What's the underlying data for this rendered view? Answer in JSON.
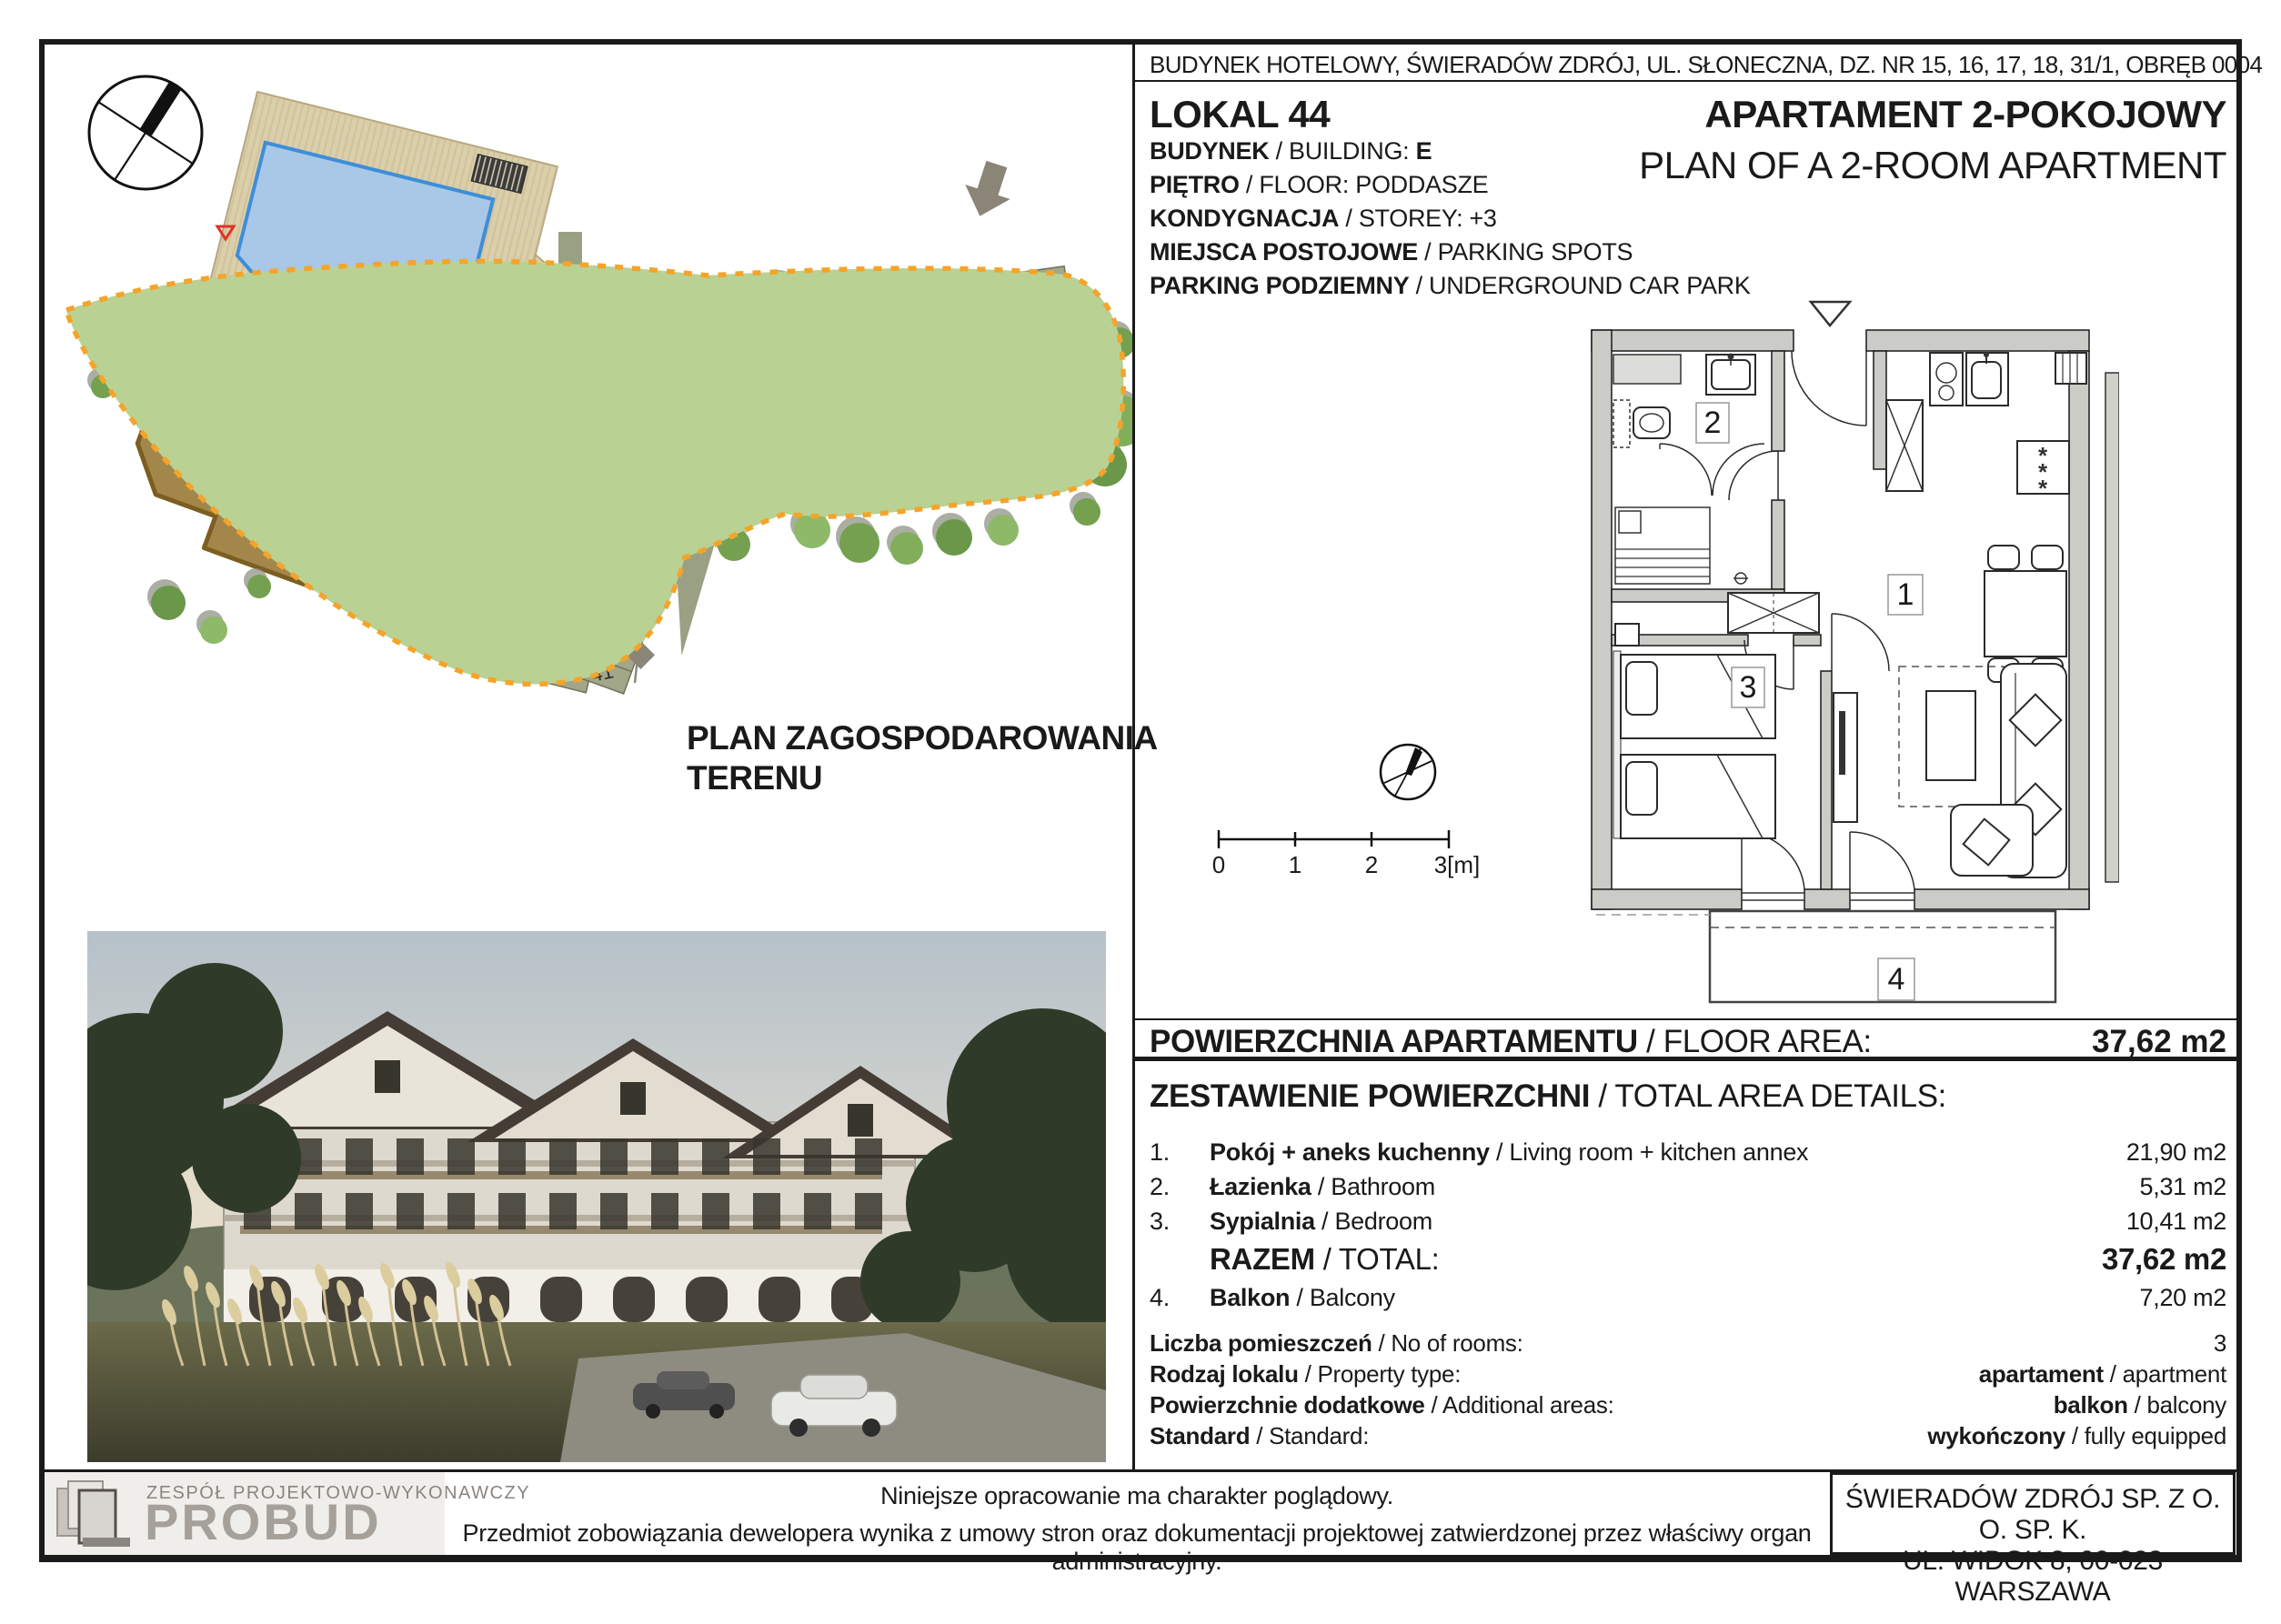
{
  "header": {
    "location_line": "BUDYNEK HOTELOWY, ŚWIERADÓW ZDRÓJ, UL. SŁONECZNA, DZ. NR 15, 16, 17, 18, 31/1, OBRĘB 0004",
    "unit": "LOKAL 44",
    "title_pl": "APARTAMENT 2-POKOJOWY",
    "title_en": "PLAN OF A 2-ROOM APARTMENT",
    "details": [
      {
        "pl": "BUDYNEK",
        "en": " / BUILDING: ",
        "val": "E"
      },
      {
        "pl": "PIĘTRO",
        "en": " / FLOOR: PODDASZE",
        "val": ""
      },
      {
        "pl": "KONDYGNACJA",
        "en": " / STOREY: +3",
        "val": ""
      },
      {
        "pl": "MIEJSCA POSTOJOWE",
        "en": " / PARKING SPOTS",
        "val": ""
      },
      {
        "pl": "PARKING PODZIEMNY",
        "en": " / UNDERGROUND CAR PARK",
        "val": ""
      }
    ]
  },
  "floor_area": {
    "pl": "POWIERZCHNIA APARTAMENTU",
    "en": " / FLOOR AREA:",
    "value": "37,62 m2"
  },
  "area_details": {
    "heading_pl": "ZESTAWIENIE POWIERZCHNI",
    "heading_en": " / TOTAL AREA DETAILS:",
    "rows": [
      {
        "no": "1.",
        "pl": "Pokój + aneks kuchenny",
        "en": " / Living room + kitchen annex",
        "value": "21,90 m2"
      },
      {
        "no": "2.",
        "pl": "Łazienka",
        "en": " / Bathroom",
        "value": "5,31 m2"
      },
      {
        "no": "3.",
        "pl": "Sypialnia",
        "en": " / Bedroom",
        "value": "10,41 m2"
      },
      {
        "no": "",
        "pl": "RAZEM",
        "en": " / TOTAL:",
        "value": "37,62 m2",
        "cls": "total"
      },
      {
        "no": "4.",
        "pl": "Balkon",
        "en": " / Balcony",
        "value": "7,20 m2"
      }
    ]
  },
  "property_info": [
    {
      "pl": "Liczba pomieszczeń",
      "en": " / No of rooms:",
      "vb": "",
      "vr": "3"
    },
    {
      "pl": "Rodzaj lokalu",
      "en": " / Property type:",
      "vb": "apartament",
      "vr": " / apartment"
    },
    {
      "pl": "Powierzchnie dodatkowe",
      "en": " / Additional areas:",
      "vb": "balkon",
      "vr": " / balcony"
    },
    {
      "pl": "Standard",
      "en": " / Standard:",
      "vb": "wykończony",
      "vr": " / fully equipped"
    }
  ],
  "site_plan": {
    "title_line1": "PLAN ZAGOSPODAROWANIA",
    "title_line2": "TERENU",
    "building_e": "Bud. E",
    "building_d": "Bud. D",
    "parking_left": [
      "12",
      "13",
      "14",
      "15",
      "16",
      "17",
      "18",
      "19"
    ],
    "parking_mid_left": [
      "30",
      "29",
      "28",
      "27",
      "26",
      "25",
      "24",
      "23",
      "22",
      "21",
      "20"
    ],
    "parking_mid_right": [
      "33",
      "34",
      "35",
      "36",
      "37",
      "38",
      "39",
      "40",
      "41"
    ],
    "parking_top_pair": [
      "31",
      "32"
    ],
    "parking_top": [
      "7",
      "10",
      "9",
      "8"
    ],
    "parking_d": [
      "1",
      "2",
      "3"
    ],
    "parking_d_extra": [
      "4"
    ]
  },
  "floor_plan": {
    "rooms": [
      "1",
      "2",
      "3",
      "4"
    ],
    "scale_ticks": [
      "0",
      "1",
      "2",
      "3[m]"
    ]
  },
  "footer": {
    "logo_top": "ZESPÓŁ PROJEKTOWO-WYKONAWCZY",
    "logo_name": "PROBUD",
    "note1": "Niniejsze opracowanie ma charakter  poglądowy.",
    "note2": "Przedmiot zobowiązania dewelopera wynika z umowy stron oraz dokumentacji projektowej zatwierdzonej przez właściwy organ administracyjny.",
    "address1": "ŚWIERADÓW ZDRÓJ SP. Z O. O. SP. K.",
    "address2": "UL. WIDOK 8, 00-023 WARSZAWA"
  },
  "colors": {
    "site_green": "#b9d294",
    "road_gray": "#9aa083",
    "building_brown": "#a3874a",
    "boundary_orange": "#f4a42a",
    "pool_blue": "#a9c7e7",
    "marker_red": "#e23324",
    "wall_gray": "#cbcbc7"
  }
}
